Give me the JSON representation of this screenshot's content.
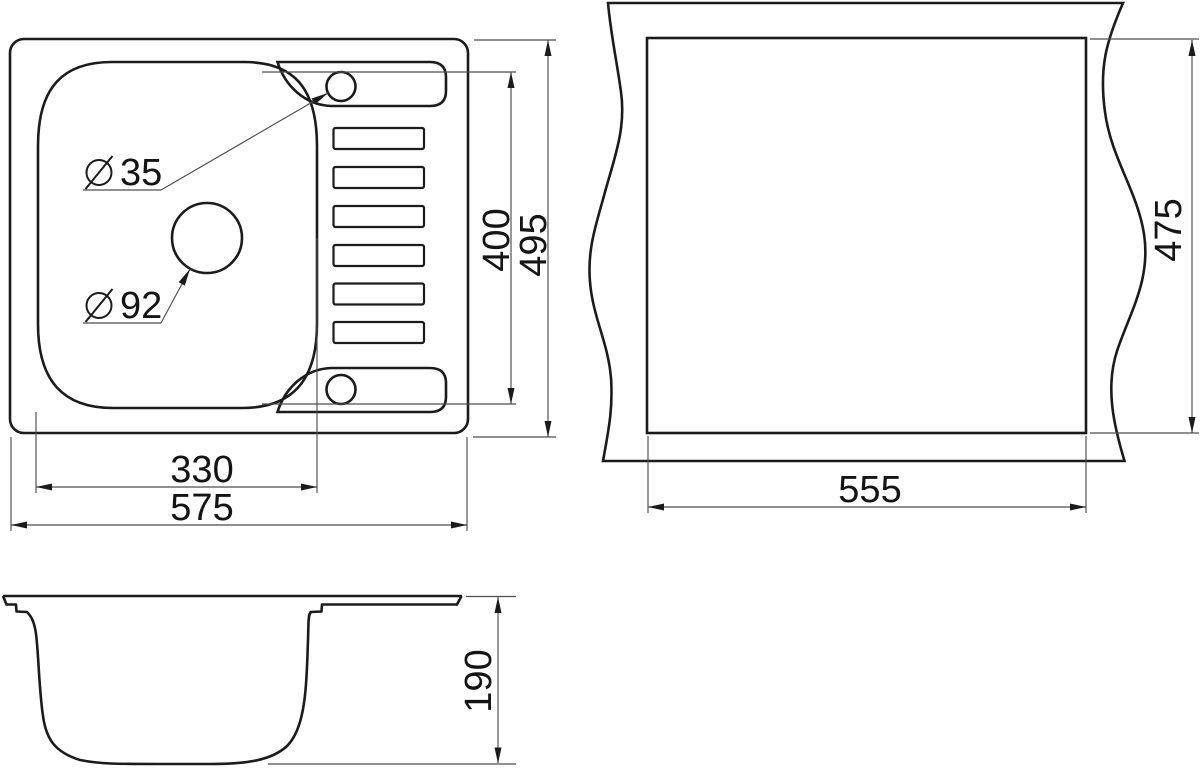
{
  "top_view": {
    "dim_bowl_width_mm": "330",
    "dim_overall_width_mm": "575",
    "dim_right_section_mm": "400",
    "dim_overall_depth_mm": "495",
    "faucet_hole": {
      "symbol": "⌀",
      "diameter_mm": "35"
    },
    "drain_hole": {
      "symbol": "⌀",
      "diameter_mm": "92"
    }
  },
  "cutout_view": {
    "dim_width_mm": "555",
    "dim_depth_mm": "475"
  },
  "side_view": {
    "dim_depth_mm": "190"
  },
  "style": {
    "object_line_color": "#1b1b1b",
    "dimension_line_color": "#4d4d4d",
    "background_color": "#ffffff"
  }
}
